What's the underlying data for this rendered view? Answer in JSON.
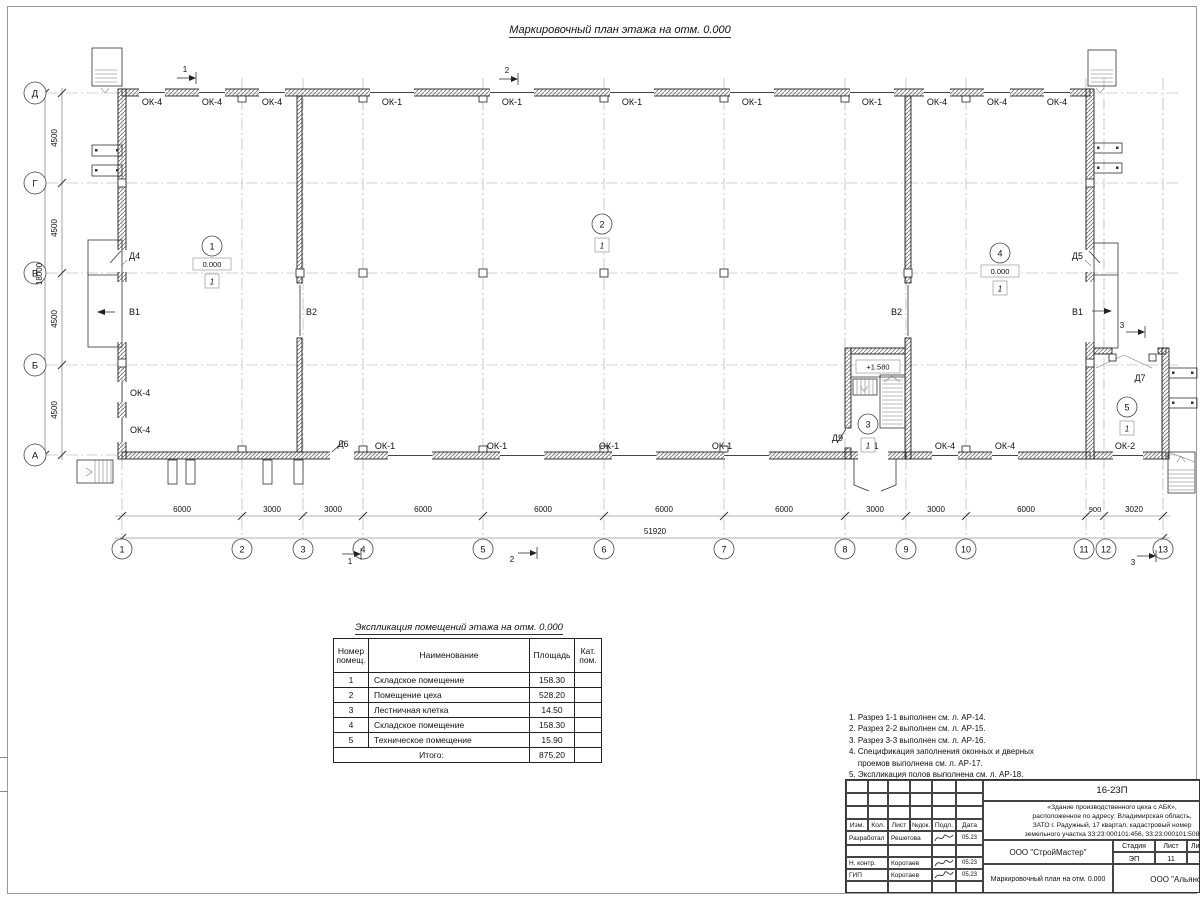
{
  "title": "Маркировочный план этажа на отм. 0.000",
  "grid": {
    "rows": [
      "Д",
      "Г",
      "В",
      "Б",
      "А"
    ],
    "cols": [
      "1",
      "2",
      "3",
      "4",
      "5",
      "6",
      "7",
      "8",
      "9",
      "10",
      "11",
      "12",
      "13"
    ]
  },
  "dims": {
    "left": [
      "4500",
      "4500",
      "4500",
      "4500"
    ],
    "left_total": "18000",
    "bottom": [
      "6000",
      "3000",
      "3000",
      "6000",
      "6000",
      "6000",
      "6000",
      "3000",
      "3000",
      "6000",
      "900",
      "3020"
    ],
    "bottom_total": "51920"
  },
  "sections": {
    "one": "1",
    "two": "2",
    "three": "3"
  },
  "windows": {
    "top": [
      "ОК-4",
      "ОК-4",
      "ОК-4",
      "ОК-1",
      "ОК-1",
      "ОК-1",
      "ОК-1",
      "ОК-1",
      "ОК-4",
      "ОК-4",
      "ОК-4"
    ],
    "bottom": [
      "ОК-1",
      "ОК-1",
      "ОК-1",
      "ОК-1",
      "ОК-4",
      "ОК-4",
      "ОК-2"
    ],
    "left": [
      "ОК-4",
      "ОК-4"
    ]
  },
  "doors": {
    "d1": "Д1",
    "d4": "Д4",
    "d5": "Д5",
    "d6": "Д6",
    "d7": "Д7",
    "d9": "Д9"
  },
  "gates": {
    "left_b1": "В1",
    "mid_left_b2": "В2",
    "mid_right_b2": "В2",
    "right_b1": "В1"
  },
  "marks": {
    "elev_zero": "0.000",
    "elev_landing": "+1.580",
    "floor_type": "1"
  },
  "rooms": [
    "1",
    "2",
    "3",
    "4",
    "5"
  ],
  "legend_table": {
    "title": "Экспликация помещений этажа на отм. 0.000",
    "headers": {
      "num": "Номер помещ.",
      "name": "Наименование",
      "area": "Площадь",
      "cat": "Кат. пом."
    },
    "rows": [
      {
        "num": "1",
        "name": "Складское помещение",
        "area": "158.30"
      },
      {
        "num": "2",
        "name": "Помещение цеха",
        "area": "528.20"
      },
      {
        "num": "3",
        "name": "Лестничная клетка",
        "area": "14.50"
      },
      {
        "num": "4",
        "name": "Складское помещение",
        "area": "158.30"
      },
      {
        "num": "5",
        "name": "Техническое помещение",
        "area": "15.90"
      }
    ],
    "total_label": "Итого:",
    "total": "875.20"
  },
  "notes": [
    "1. Разрез 1-1 выполнен см. л. АР-14.",
    "2. Разрез 2-2 выполнен см. л. АР-15.",
    "3. Разрез 3-3 выполнен см. л. АР-16.",
    "4. Спецификация заполнения оконных и дверных",
    "    проемов выполнена см. л. АР-17.",
    "5. Экспликация полов выполнена см. л. АР-18."
  ],
  "titleblock": {
    "doc_number": "16-23П",
    "object_lines": [
      "«Здание производственного цеха с АБК»,",
      "расположенное по адресу: Владимирская область,",
      "ЗАТО г. Радужный, 17 квартал, кадастровый номер",
      "земельного участка 33:23:000101:456, 33:23:000101:508"
    ],
    "rev_headers": [
      "Изм.",
      "Кол.",
      "Лист",
      "№док.",
      "Подл.",
      "Дата"
    ],
    "sign_rows": [
      {
        "role": "Разработал",
        "name": "Решетова",
        "date": "05.23"
      },
      {
        "role": "Н. контр.",
        "name": "Коротаев",
        "date": "05.23"
      },
      {
        "role": "ГИП",
        "name": "Коротаев",
        "date": "05.23"
      }
    ],
    "company": "ООО \"СтройМастер\"",
    "stage_label": "Стадия",
    "stage": "ЭП",
    "sheet_label": "Лист",
    "sheet": "11",
    "sheets_label": "Листов",
    "sheets": "1",
    "drawing_title": "Маркировочный план на отм. 0.000",
    "contractor": "ООО \"Альянс\""
  }
}
